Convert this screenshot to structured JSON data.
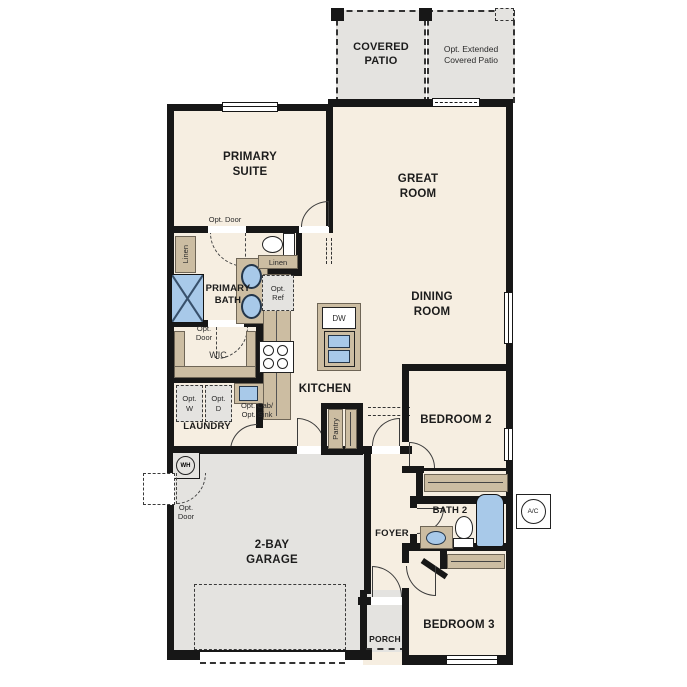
{
  "palette": {
    "floor_beige": "#f6eee1",
    "floor_gray": "#e4e3e0",
    "cabinet_tan": "#ccbda2",
    "fixture_blue": "#a8c9e9",
    "wall_black": "#171717"
  },
  "rooms": {
    "covered_patio": "COVERED\nPATIO",
    "opt_extended_patio": "Opt. Extended\nCovered Patio",
    "primary_suite": "PRIMARY\nSUITE",
    "great_room": "GREAT\nROOM",
    "dining_room": "DINING\nROOM",
    "primary_bath": "PRIMARY\nBATH",
    "wic": "WIC",
    "laundry": "LAUNDRY",
    "kitchen": "KITCHEN",
    "pantry": "Pantry",
    "bedroom2": "BEDROOM 2",
    "bath2": "BATH 2",
    "foyer": "FOYER",
    "bedroom3": "BEDROOM 3",
    "porch": "PORCH",
    "garage": "2-BAY\nGARAGE"
  },
  "annotations": {
    "opt_door_suite": "Opt. Door",
    "opt_door_wic": "Opt.\nDoor",
    "opt_door_garage": "Opt.\nDoor",
    "opt_washer": "Opt.\nW",
    "opt_dryer": "Opt.\nD",
    "opt_cab_sink": "Opt. Cab/\nOpt. Sink",
    "opt_ref": "Opt.\nRef",
    "linen_bath": "Linen",
    "linen_hall": "Linen",
    "dishwasher": "DW",
    "water_heater": "WH",
    "ac_unit": "A/C"
  }
}
